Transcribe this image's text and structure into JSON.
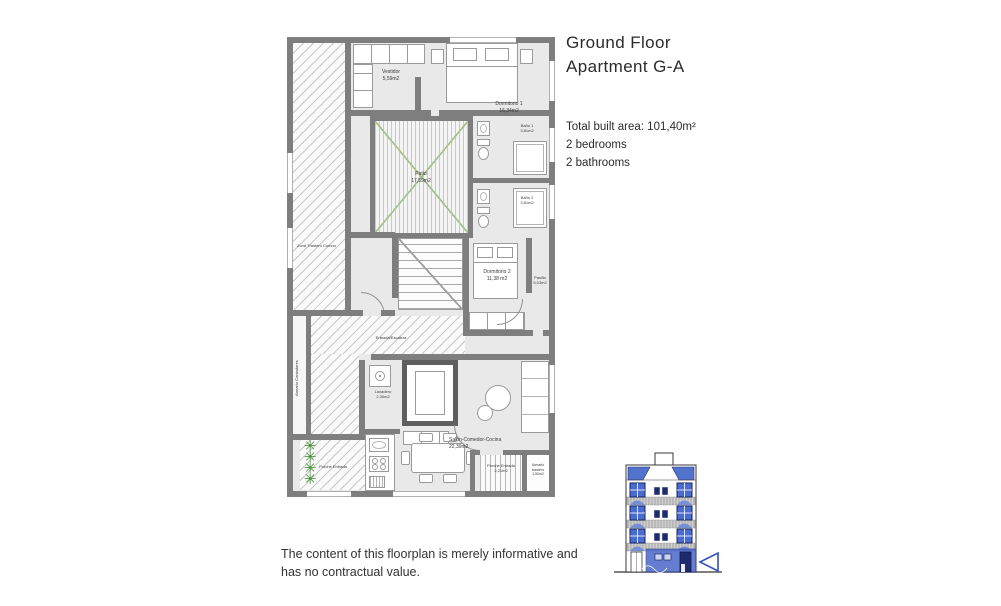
{
  "header": {
    "title_line1": "Ground Floor",
    "title_line2": "Apartment G-A"
  },
  "summary": {
    "total_area": "Total built area: 101,40m²",
    "bedrooms": "2 bedrooms",
    "bathrooms": "2 bathrooms"
  },
  "disclaimer": {
    "line1": "The content of this floorplan is merely informative and",
    "line2": "has no contractual value."
  },
  "rooms": {
    "vestidor": {
      "name": "Vestidor",
      "area": "5,59m2"
    },
    "dormitorio1": {
      "name": "Dormitorio 1",
      "area": "16,34m2"
    },
    "bano1": {
      "name": "Baño 1",
      "area": "3,81m2"
    },
    "bano2": {
      "name": "Baño 2",
      "area": "3,81m2"
    },
    "patio": {
      "name": "Patio",
      "area": "17,59m2"
    },
    "zona_trastero": {
      "name": "Zona Trastero Común",
      "area": ""
    },
    "dormitorio2": {
      "name": "Dormitorio 2",
      "area": "11,38 m2"
    },
    "pasillo": {
      "name": "Pasillo",
      "area": "5,03m2"
    },
    "entrada": {
      "name": "Entrada/Escalera",
      "area": ""
    },
    "armario_contadores": {
      "name": "Armario Contadores",
      "area": ""
    },
    "lavadero": {
      "name": "Lavadero",
      "area": "2,30m2"
    },
    "salon": {
      "name": "Salón-Comedor-Cocina",
      "area": "22,39m2"
    },
    "porche_entrada_oeste": {
      "name": "Porche Entrada",
      "area": ""
    },
    "porche_entrada_sur": {
      "name": "Porche Entrada",
      "area": "2,21m2"
    },
    "armario_trastero": {
      "name": "Armario trastero",
      "area": "1,50m2"
    }
  },
  "icons": {
    "plant": "✳",
    "location_arrow": "left-pointing-triangle"
  },
  "colors": {
    "wall": "#7e7e7e",
    "floor": "#e9e9e9",
    "patio_green": "#a8c08d",
    "plant_green": "#3c8a2e",
    "elevation_blue": "#4a67c9",
    "elevation_dark_blue": "#1d2b6e",
    "text": "#2e2e2e"
  }
}
